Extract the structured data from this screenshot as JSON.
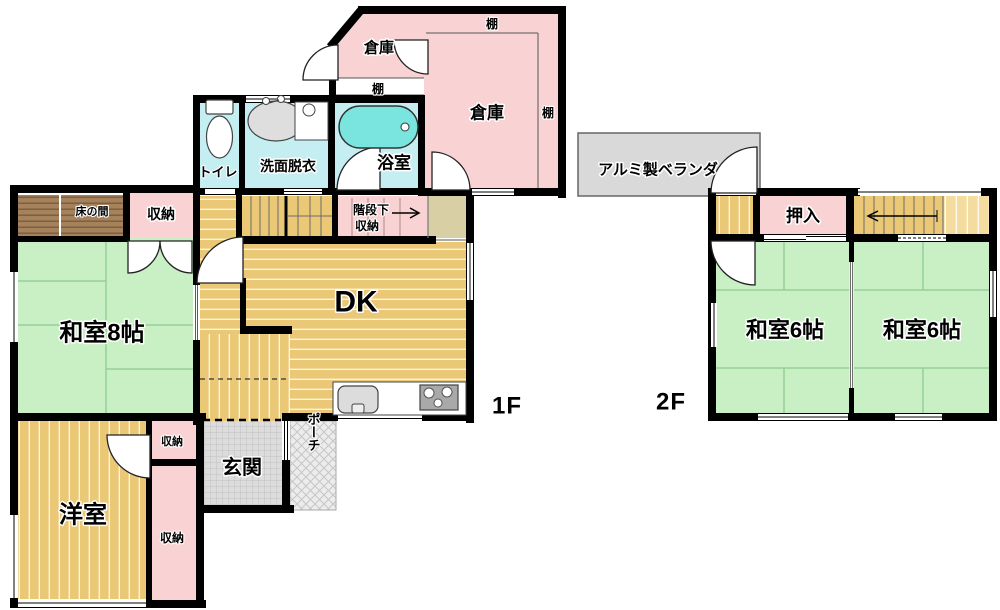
{
  "title": "floor-plan",
  "f1": {
    "floor_label": "1F",
    "souko_small": "倉庫",
    "tana_small": "棚",
    "souko_large": "倉庫",
    "tana_large_top": "棚",
    "tana_large_right": "棚",
    "toilet": "トイレ",
    "senmen": "洗面脱衣",
    "bath": "浴室",
    "tokonoma": "床の間",
    "shuno_top": "収納",
    "kaidan_line1": "階段下",
    "kaidan_line2": "収納",
    "washitsu8": "和室8帖",
    "dk": "DK",
    "shuno_mid": "収納",
    "genkan": "玄関",
    "porch": "ポーチ",
    "yoshitsu": "洋室",
    "shuno_bottom": "収納"
  },
  "f2": {
    "floor_label": "2F",
    "veranda": "アルミ製ベランダ",
    "oshiire": "押入",
    "washitsu6_left": "和室6帖",
    "washitsu6_right": "和室6帖"
  },
  "palette": {
    "wall": "#000000",
    "pink": "#f9d3d3",
    "cyan": "#c5eef2",
    "green": "#c9efc5",
    "tan": "#ebc876",
    "tanlight": "#f3dc9e",
    "khaki": "#d9cfa5",
    "teal": "#79e5de",
    "veranda": "#d9d9d9",
    "genkan": "#dcdcdc",
    "porch": "#ececec",
    "tokonoma": "#a5825c"
  }
}
